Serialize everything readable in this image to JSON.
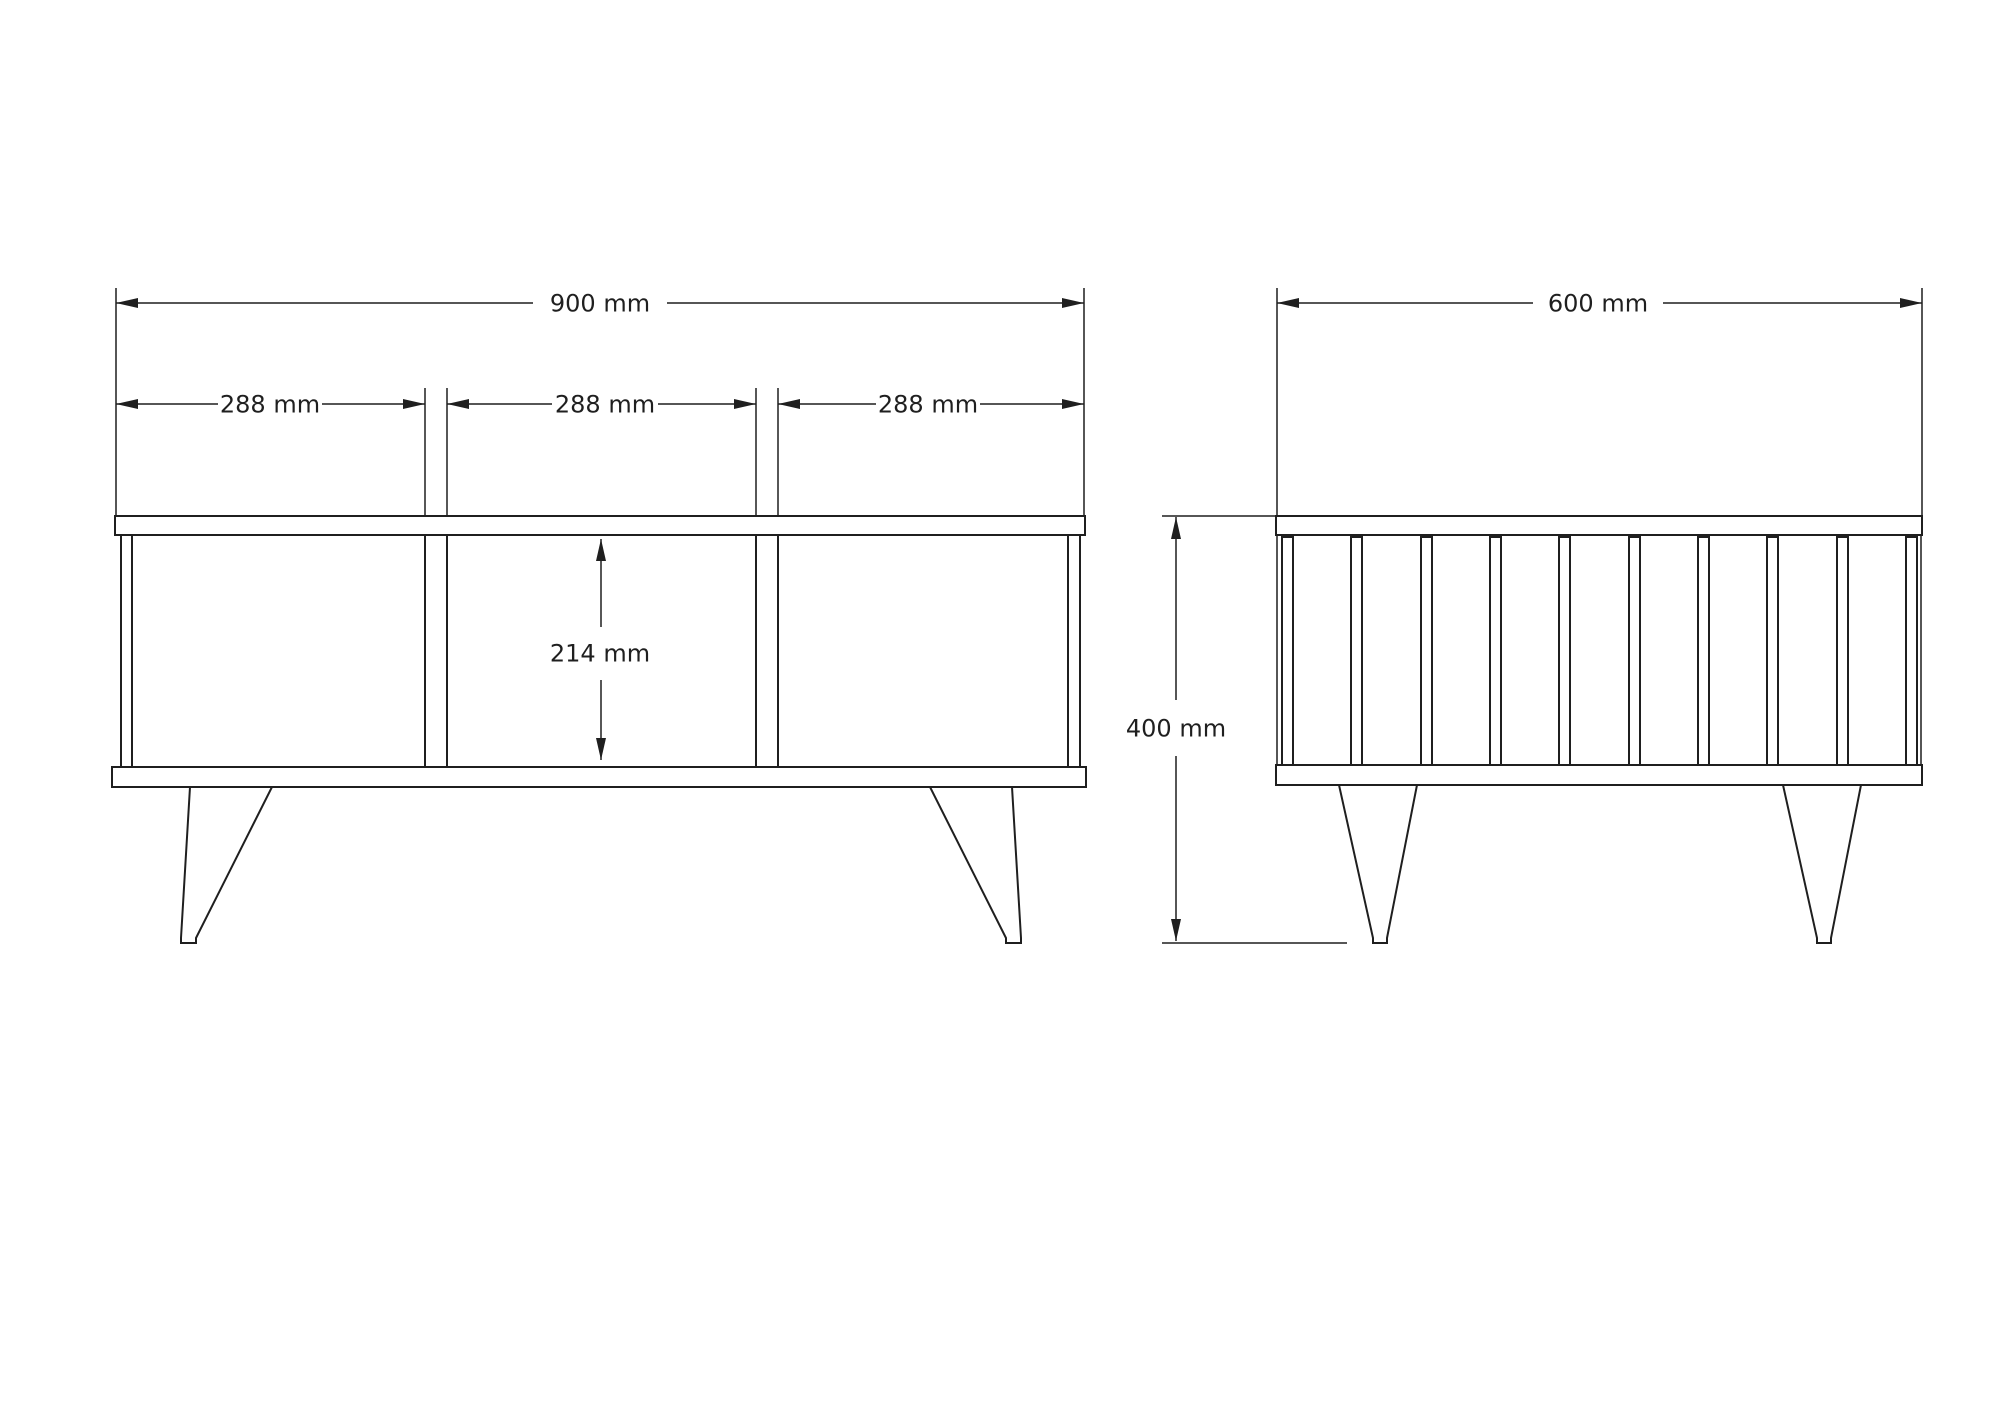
{
  "page": {
    "background": "#ffffff",
    "width": 2000,
    "height": 1414
  },
  "drawing": {
    "stroke_color": "#1f1f1f",
    "fill_white": "#ffffff",
    "dimension_labels": {
      "front_total_width": "900 mm",
      "front_section_1": "288 mm",
      "front_section_2": "288 mm",
      "front_section_3": "288 mm",
      "front_opening_height": "214 mm",
      "side_total_depth": "600 mm",
      "side_total_height": "400 mm"
    },
    "rects": [
      {
        "name": "front-top-board",
        "x": 115,
        "y": 516,
        "w": 970,
        "h": 19
      },
      {
        "name": "front-bottom-board",
        "x": 112,
        "y": 767,
        "w": 974,
        "h": 20
      },
      {
        "name": "front-side-panel-left",
        "x": 121,
        "y": 535,
        "w": 11,
        "h": 232
      },
      {
        "name": "front-side-panel-right",
        "x": 1068,
        "y": 535,
        "w": 12,
        "h": 232
      },
      {
        "name": "front-divider-left",
        "x": 425,
        "y": 535,
        "w": 22,
        "h": 232
      },
      {
        "name": "front-divider-right",
        "x": 756,
        "y": 535,
        "w": 22,
        "h": 232
      },
      {
        "name": "side-top-board",
        "x": 1276,
        "y": 516,
        "w": 646,
        "h": 19
      },
      {
        "name": "side-bottom-board",
        "x": 1276,
        "y": 765,
        "w": 646,
        "h": 20
      },
      {
        "name": "side-slat",
        "x": 1282,
        "y": 537,
        "w": 11,
        "h": 228
      },
      {
        "name": "side-slat",
        "x": 1351,
        "y": 537,
        "w": 11,
        "h": 228
      },
      {
        "name": "side-slat",
        "x": 1421,
        "y": 537,
        "w": 11,
        "h": 228
      },
      {
        "name": "side-slat",
        "x": 1490,
        "y": 537,
        "w": 11,
        "h": 228
      },
      {
        "name": "side-slat",
        "x": 1559,
        "y": 537,
        "w": 11,
        "h": 228
      },
      {
        "name": "side-slat",
        "x": 1629,
        "y": 537,
        "w": 11,
        "h": 228
      },
      {
        "name": "side-slat",
        "x": 1698,
        "y": 537,
        "w": 11,
        "h": 228
      },
      {
        "name": "side-slat",
        "x": 1767,
        "y": 537,
        "w": 11,
        "h": 228
      },
      {
        "name": "side-slat",
        "x": 1837,
        "y": 537,
        "w": 11,
        "h": 228
      },
      {
        "name": "side-slat",
        "x": 1906,
        "y": 537,
        "w": 11,
        "h": 228
      }
    ],
    "lines": [
      {
        "name": "dim-900-line-left",
        "x1": 116,
        "y1": 303,
        "x2": 533,
        "y2": 303
      },
      {
        "name": "dim-900-line-right",
        "x1": 667,
        "y1": 303,
        "x2": 1084,
        "y2": 303
      },
      {
        "name": "ext-front-left",
        "x1": 116,
        "y1": 288,
        "x2": 116,
        "y2": 516
      },
      {
        "name": "ext-front-right",
        "x1": 1084,
        "y1": 288,
        "x2": 1084,
        "y2": 516
      },
      {
        "name": "dim-288a-line-left",
        "x1": 116,
        "y1": 404,
        "x2": 218,
        "y2": 404
      },
      {
        "name": "dim-288a-line-right",
        "x1": 322,
        "y1": 404,
        "x2": 425,
        "y2": 404
      },
      {
        "name": "ext-divider1-left",
        "x1": 425,
        "y1": 388,
        "x2": 425,
        "y2": 516
      },
      {
        "name": "ext-divider1-right",
        "x1": 447,
        "y1": 388,
        "x2": 447,
        "y2": 516
      },
      {
        "name": "dim-288b-line-left",
        "x1": 447,
        "y1": 404,
        "x2": 552,
        "y2": 404
      },
      {
        "name": "dim-288b-line-right",
        "x1": 658,
        "y1": 404,
        "x2": 756,
        "y2": 404
      },
      {
        "name": "ext-divider2-left",
        "x1": 756,
        "y1": 388,
        "x2": 756,
        "y2": 516
      },
      {
        "name": "ext-divider2-right",
        "x1": 778,
        "y1": 388,
        "x2": 778,
        "y2": 516
      },
      {
        "name": "dim-288c-line-left",
        "x1": 778,
        "y1": 404,
        "x2": 876,
        "y2": 404
      },
      {
        "name": "dim-288c-line-right",
        "x1": 980,
        "y1": 404,
        "x2": 1084,
        "y2": 404
      },
      {
        "name": "dim-214-line-top",
        "x1": 601,
        "y1": 539,
        "x2": 601,
        "y2": 627
      },
      {
        "name": "dim-214-line-bottom",
        "x1": 601,
        "y1": 680,
        "x2": 601,
        "y2": 760
      },
      {
        "name": "dim-600-line-left",
        "x1": 1277,
        "y1": 303,
        "x2": 1533,
        "y2": 303
      },
      {
        "name": "dim-600-line-right",
        "x1": 1663,
        "y1": 303,
        "x2": 1922,
        "y2": 303
      },
      {
        "name": "ext-side-left",
        "x1": 1277,
        "y1": 288,
        "x2": 1277,
        "y2": 516
      },
      {
        "name": "ext-side-right",
        "x1": 1922,
        "y1": 288,
        "x2": 1922,
        "y2": 516
      },
      {
        "name": "side-body-edge-left",
        "x1": 1277,
        "y1": 535,
        "x2": 1277,
        "y2": 765
      },
      {
        "name": "side-body-edge-right",
        "x1": 1921,
        "y1": 535,
        "x2": 1921,
        "y2": 765
      },
      {
        "name": "dim-400-line-top",
        "x1": 1176,
        "y1": 517,
        "x2": 1176,
        "y2": 700
      },
      {
        "name": "dim-400-line-bottom",
        "x1": 1176,
        "y1": 756,
        "x2": 1176,
        "y2": 941
      },
      {
        "name": "ext-400-top",
        "x1": 1162,
        "y1": 516,
        "x2": 1277,
        "y2": 516
      },
      {
        "name": "ext-400-floor",
        "x1": 1162,
        "y1": 943,
        "x2": 1347,
        "y2": 943
      }
    ],
    "legs": [
      {
        "name": "front-leg-left",
        "points": "190,787 272,787 196,938 196,943 181,943 181,938"
      },
      {
        "name": "front-leg-right",
        "points": "1012,787 930,787 1006,938 1006,943 1021,943 1021,938"
      },
      {
        "name": "side-leg-left",
        "points": "1339,785 1417,785 1387,938 1387,943 1373,943 1373,938"
      },
      {
        "name": "side-leg-right",
        "points": "1783,785 1861,785 1831,938 1831,943 1817,943 1817,938"
      }
    ],
    "arrowheads": [
      {
        "name": "arrow-900-left",
        "points": "116,303 138,298 138,308"
      },
      {
        "name": "arrow-900-right",
        "points": "1084,303 1062,298 1062,308"
      },
      {
        "name": "arrow-288a-left",
        "points": "116,404 138,399 138,409"
      },
      {
        "name": "arrow-288a-right",
        "points": "425,404 403,399 403,409"
      },
      {
        "name": "arrow-288b-left",
        "points": "447,404 469,399 469,409"
      },
      {
        "name": "arrow-288b-right",
        "points": "756,404 734,399 734,409"
      },
      {
        "name": "arrow-288c-left",
        "points": "778,404 800,399 800,409"
      },
      {
        "name": "arrow-288c-right",
        "points": "1084,404 1062,399 1062,409"
      },
      {
        "name": "arrow-214-up",
        "points": "601,539 596,561 606,561"
      },
      {
        "name": "arrow-214-down",
        "points": "601,760 596,738 606,738"
      },
      {
        "name": "arrow-600-left",
        "points": "1277,303 1299,298 1299,308"
      },
      {
        "name": "arrow-600-right",
        "points": "1922,303 1900,298 1900,308"
      },
      {
        "name": "arrow-400-up",
        "points": "1176,517 1171,539 1181,539"
      },
      {
        "name": "arrow-400-down",
        "points": "1176,941 1171,919 1181,919"
      }
    ],
    "texts": [
      {
        "name": "dim-label-900",
        "x": 600,
        "y": 303,
        "text": "900 mm"
      },
      {
        "name": "dim-label-288-1",
        "x": 270,
        "y": 404,
        "text": "288 mm"
      },
      {
        "name": "dim-label-288-2",
        "x": 605,
        "y": 404,
        "text": "288 mm"
      },
      {
        "name": "dim-label-288-3",
        "x": 928,
        "y": 404,
        "text": "288 mm"
      },
      {
        "name": "dim-label-214",
        "x": 600,
        "y": 653,
        "text": "214 mm"
      },
      {
        "name": "dim-label-600",
        "x": 1598,
        "y": 303,
        "text": "600 mm"
      },
      {
        "name": "dim-label-400",
        "x": 1176,
        "y": 728,
        "text": "400 mm"
      }
    ]
  }
}
